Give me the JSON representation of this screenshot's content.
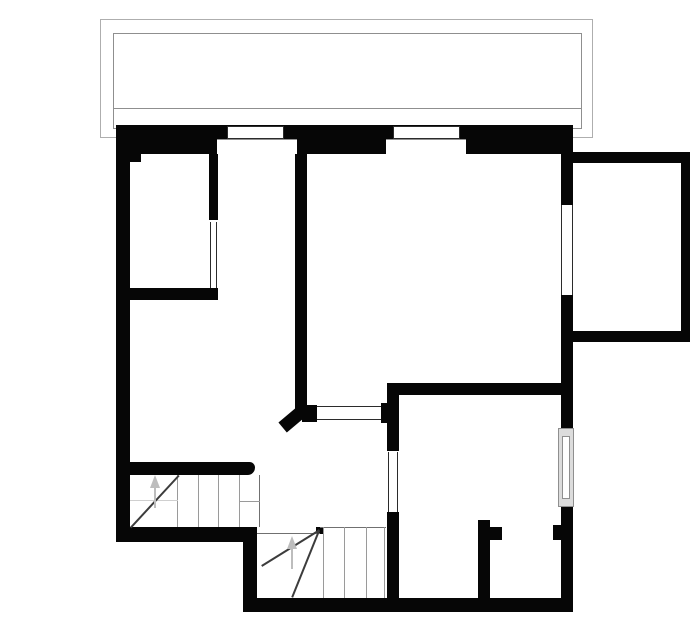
{
  "canvas": {
    "w": 700,
    "h": 644,
    "bg": "#ffffff"
  },
  "colors": {
    "wall": "#060606",
    "thin": "#2b2b2b",
    "outline": "#8f8f8f",
    "outline_light": "#aeaeae",
    "stair": "#9a9a9a",
    "stair_bold": "#707070",
    "stair_faint": "#cfcfcf",
    "dark": "#3c3c3c",
    "arrow": "#bdbdbd",
    "glass": "#dcdcdc",
    "white": "#ffffff"
  },
  "outlines": [
    {
      "name": "balcony-outer-rail",
      "x": 100,
      "y": 19,
      "w": 493,
      "h": 119,
      "color": "outline_light"
    },
    {
      "name": "balcony-inner-rail",
      "x": 113,
      "y": 33,
      "w": 469,
      "h": 96,
      "color": "outline"
    }
  ],
  "rects": [
    {
      "name": "top-wall",
      "x": 116,
      "y": 125,
      "w": 457,
      "h": 29,
      "fill": "wall"
    },
    {
      "name": "left-wall",
      "x": 116,
      "y": 125,
      "w": 14,
      "h": 417,
      "fill": "wall"
    },
    {
      "name": "left-inner-corner-step",
      "x": 129,
      "y": 154,
      "w": 12,
      "h": 8,
      "fill": "wall"
    },
    {
      "name": "right-wall-upper",
      "x": 561,
      "y": 125,
      "w": 12,
      "h": 80,
      "fill": "wall"
    },
    {
      "name": "right-wall-mid",
      "x": 561,
      "y": 295,
      "w": 12,
      "h": 133,
      "fill": "wall"
    },
    {
      "name": "right-wall-lower",
      "x": 561,
      "y": 507,
      "w": 12,
      "h": 105,
      "fill": "wall"
    },
    {
      "name": "bottom-left-wall",
      "x": 116,
      "y": 527,
      "w": 141,
      "h": 15,
      "fill": "wall"
    },
    {
      "name": "step-out-wall",
      "x": 243,
      "y": 540,
      "w": 14,
      "h": 72,
      "fill": "wall"
    },
    {
      "name": "bottom-wall",
      "x": 243,
      "y": 598,
      "w": 330,
      "h": 14,
      "fill": "wall"
    },
    {
      "name": "room1-wall-vertical",
      "x": 209,
      "y": 154,
      "w": 9,
      "h": 66,
      "fill": "wall"
    },
    {
      "name": "room1-wall-bottom",
      "x": 129,
      "y": 288,
      "w": 89,
      "h": 12,
      "fill": "wall"
    },
    {
      "name": "central-wall",
      "x": 295,
      "y": 154,
      "w": 12,
      "h": 256,
      "fill": "wall"
    },
    {
      "name": "hatch-cap-left",
      "x": 302,
      "y": 405,
      "w": 15,
      "h": 17,
      "fill": "wall"
    },
    {
      "name": "hatch-cap-right",
      "x": 381,
      "y": 403,
      "w": 18,
      "h": 20,
      "fill": "wall"
    },
    {
      "name": "room2-wall-top",
      "x": 387,
      "y": 383,
      "w": 174,
      "h": 12,
      "fill": "wall"
    },
    {
      "name": "room2-wall-left-upper",
      "x": 387,
      "y": 395,
      "w": 12,
      "h": 56,
      "fill": "wall"
    },
    {
      "name": "room2-wall-left-lower",
      "x": 387,
      "y": 512,
      "w": 12,
      "h": 87,
      "fill": "wall"
    },
    {
      "name": "closet-partition-wall",
      "x": 478,
      "y": 520,
      "w": 12,
      "h": 79,
      "fill": "wall"
    },
    {
      "name": "closet-partition-foot",
      "x": 490,
      "y": 527,
      "w": 12,
      "h": 13,
      "fill": "wall"
    },
    {
      "name": "door-stub-right-wall",
      "x": 553,
      "y": 525,
      "w": 8,
      "h": 15,
      "fill": "wall"
    },
    {
      "name": "stair-side-wall",
      "x": 130,
      "y": 462,
      "w": 125,
      "h": 13,
      "fill": "wall",
      "radius": "0 9px 12px 0"
    },
    {
      "name": "bay-window-wall-top",
      "x": 573,
      "y": 152,
      "w": 117,
      "h": 11,
      "fill": "wall"
    },
    {
      "name": "bay-window-wall-right",
      "x": 681,
      "y": 152,
      "w": 9,
      "h": 190,
      "fill": "wall"
    },
    {
      "name": "bay-window-wall-bottom",
      "x": 573,
      "y": 331,
      "w": 117,
      "h": 11,
      "fill": "wall"
    },
    {
      "name": "stair-winder-pivot",
      "x": 316,
      "y": 527,
      "w": 7,
      "h": 7,
      "fill": "wall"
    }
  ],
  "rotated": [
    {
      "name": "diagonal-wall-end",
      "cx": 294,
      "cy": 417,
      "w": 31,
      "h": 13,
      "angle": -40,
      "fill": "wall"
    }
  ],
  "openings": [
    {
      "name": "window-top-1-frame",
      "x": 227,
      "y": 126,
      "w": 57,
      "h": 13,
      "edges": "all",
      "color": "thin",
      "fill": "white"
    },
    {
      "name": "window-top-1-niche",
      "x": 217,
      "y": 139,
      "w": 80,
      "h": 15,
      "edges": "t",
      "color": "outline",
      "fill": "white"
    },
    {
      "name": "window-top-2-frame",
      "x": 393,
      "y": 126,
      "w": 67,
      "h": 13,
      "edges": "all",
      "color": "thin",
      "fill": "white"
    },
    {
      "name": "window-top-2-niche",
      "x": 386,
      "y": 139,
      "w": 80,
      "h": 15,
      "edges": "t",
      "color": "outline",
      "fill": "white"
    },
    {
      "name": "window-right-upper",
      "x": 561,
      "y": 205,
      "w": 12,
      "h": 90,
      "edges": "lr",
      "color": "thin",
      "fill": "white"
    },
    {
      "name": "serving-hatch",
      "x": 317,
      "y": 406,
      "w": 64,
      "h": 14,
      "edges": "tb",
      "color": "thin",
      "fill": "white"
    },
    {
      "name": "door-room1",
      "x": 210,
      "y": 222,
      "w": 7,
      "h": 66,
      "edges": "lr",
      "color": "thin",
      "fill": "white"
    },
    {
      "name": "door-room2",
      "x": 388,
      "y": 452,
      "w": 10,
      "h": 60,
      "edges": "lr",
      "color": "thin",
      "fill": "white"
    },
    {
      "name": "window-right-lower-outer",
      "x": 558,
      "y": 428,
      "w": 16,
      "h": 79,
      "edges": "all",
      "color": "outline",
      "fill": "glass"
    },
    {
      "name": "window-right-lower-inner",
      "x": 562,
      "y": 436,
      "w": 8,
      "h": 63,
      "edges": "all",
      "color": "outline",
      "fill": "white"
    }
  ],
  "lines": [
    {
      "name": "balcony-deck-line",
      "x1": 113,
      "y1": 108,
      "x2": 582,
      "y2": 108,
      "color": "outline",
      "t": 1
    },
    {
      "name": "stair-upper-tread-1",
      "x1": 178,
      "y1": 475,
      "x2": 178,
      "y2": 527,
      "color": "stair",
      "t": 1
    },
    {
      "name": "stair-upper-tread-2",
      "x1": 199,
      "y1": 475,
      "x2": 199,
      "y2": 527,
      "color": "stair",
      "t": 1
    },
    {
      "name": "stair-upper-tread-3",
      "x1": 219,
      "y1": 475,
      "x2": 219,
      "y2": 527,
      "color": "stair",
      "t": 1
    },
    {
      "name": "stair-upper-tread-4",
      "x1": 240,
      "y1": 475,
      "x2": 240,
      "y2": 527,
      "color": "stair",
      "t": 1
    },
    {
      "name": "stair-upper-edge",
      "x1": 260,
      "y1": 475,
      "x2": 260,
      "y2": 527,
      "color": "stair_bold",
      "t": 1
    },
    {
      "name": "stair-upper-winder-split",
      "x1": 240,
      "y1": 501,
      "x2": 260,
      "y2": 501,
      "color": "stair",
      "t": 1
    },
    {
      "name": "stair-upper-faint-split",
      "x1": 130,
      "y1": 500,
      "x2": 178,
      "y2": 500,
      "color": "stair_faint",
      "t": 1
    },
    {
      "name": "stair-upper-winder-diagonal",
      "x1": 130,
      "y1": 527,
      "x2": 178,
      "y2": 475,
      "color": "dark",
      "t": 2
    },
    {
      "name": "stair-lower-top-edge-left",
      "x1": 257,
      "y1": 533,
      "x2": 320,
      "y2": 533,
      "color": "stair_bold",
      "t": 1
    },
    {
      "name": "stair-lower-top-edge-right",
      "x1": 320,
      "y1": 527,
      "x2": 386,
      "y2": 527,
      "color": "stair_bold",
      "t": 1
    },
    {
      "name": "stair-lower-tread-1",
      "x1": 324,
      "y1": 527,
      "x2": 324,
      "y2": 598,
      "color": "stair",
      "t": 1
    },
    {
      "name": "stair-lower-tread-2",
      "x1": 345,
      "y1": 527,
      "x2": 345,
      "y2": 598,
      "color": "stair",
      "t": 1
    },
    {
      "name": "stair-lower-tread-3",
      "x1": 367,
      "y1": 527,
      "x2": 367,
      "y2": 598,
      "color": "stair",
      "t": 1
    },
    {
      "name": "stair-lower-edge",
      "x1": 385,
      "y1": 527,
      "x2": 385,
      "y2": 598,
      "color": "stair",
      "t": 1
    },
    {
      "name": "stair-lower-winder-diagonal-1",
      "x1": 320,
      "y1": 531,
      "x2": 262,
      "y2": 567,
      "color": "dark",
      "t": 2
    },
    {
      "name": "stair-lower-winder-diagonal-2",
      "x1": 320,
      "y1": 531,
      "x2": 293,
      "y2": 598,
      "color": "dark",
      "t": 2
    }
  ],
  "arrows": [
    {
      "name": "stair-arrow-upper",
      "x": 155,
      "y_apex": 475,
      "head_w": 11,
      "head_h": 13,
      "stem_y1": 487,
      "stem_y2": 508
    },
    {
      "name": "stair-arrow-lower",
      "x": 292,
      "y_apex": 536,
      "head_w": 11,
      "head_h": 13,
      "stem_y1": 548,
      "stem_y2": 569
    }
  ]
}
